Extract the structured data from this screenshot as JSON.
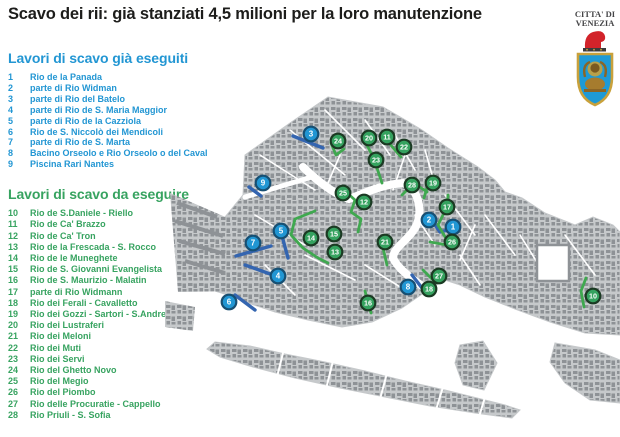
{
  "title": "Scavo dei rii: già stanziati 4,5 milioni per la loro manutenzione",
  "logo": {
    "line1": "CITTA' DI",
    "line2": "VENEZIA"
  },
  "colors": {
    "done": "#2196d3",
    "doneBorder": "#174f72",
    "todo": "#35a25f",
    "todoBorder": "#1b3a23",
    "canalDone": "#3465b0",
    "canalTodo": "#3fa84f",
    "land": "#c6c9cb",
    "building": "#8e9296"
  },
  "lists": {
    "done": {
      "heading": "Lavori di scavo già eseguiti",
      "items": [
        {
          "n": "1",
          "name": "Rio de la Panada"
        },
        {
          "n": "2",
          "name": "parte di Rio Widman"
        },
        {
          "n": "3",
          "name": "parte di Rio del Batelo"
        },
        {
          "n": "4",
          "name": "parte di Rio de S. Maria Maggior"
        },
        {
          "n": "5",
          "name": "parte di Rio de la Cazziola"
        },
        {
          "n": "6",
          "name": "Rio de S. Niccolò dei Mendicoli"
        },
        {
          "n": "7",
          "name": "parte di Rio de S. Marta"
        },
        {
          "n": "8",
          "name": "Bacino Orseolo e Rio Orseolo o del Caval"
        },
        {
          "n": "9",
          "name": "Piscina Rari Nantes"
        }
      ]
    },
    "todo": {
      "heading": "Lavori di scavo da eseguire",
      "items": [
        {
          "n": "10",
          "name": "Rio de S.Daniele - Riello"
        },
        {
          "n": "11",
          "name": "Rio de Ca' Brazzo"
        },
        {
          "n": "12",
          "name": "Rio de Ca' Tron"
        },
        {
          "n": "13",
          "name": "Rio de la Frescada - S. Rocco"
        },
        {
          "n": "14",
          "name": "Rio de le Muneghete"
        },
        {
          "n": "15",
          "name": "Rio de S. Giovanni Evangelista"
        },
        {
          "n": "16",
          "name": "Rio de S. Maurizio - Malatin"
        },
        {
          "n": "17",
          "name": "parte di Rio Widmann"
        },
        {
          "n": "18",
          "name": "Rio dei Ferali - Cavalletto"
        },
        {
          "n": "19",
          "name": "Rio dei Gozzi - Sartori - S.Andrea"
        },
        {
          "n": "20",
          "name": "Rio dei Lustraferi"
        },
        {
          "n": "21",
          "name": "Rio dei Meloni"
        },
        {
          "n": "22",
          "name": "Rio dei Muti"
        },
        {
          "n": "23",
          "name": "Rio dei Servi"
        },
        {
          "n": "24",
          "name": "Rio del Ghetto Novo"
        },
        {
          "n": "25",
          "name": "Rio del Megio"
        },
        {
          "n": "26",
          "name": "Rio del Piombo"
        },
        {
          "n": "27",
          "name": "Rio delle Procuratie - Cappello"
        },
        {
          "n": "28",
          "name": "Rio Priuli - S. Sofia"
        }
      ]
    }
  },
  "map": {
    "markers": [
      {
        "n": "1",
        "type": "done",
        "x": 288,
        "y": 132
      },
      {
        "n": "2",
        "type": "done",
        "x": 264,
        "y": 125
      },
      {
        "n": "3",
        "type": "done",
        "x": 146,
        "y": 39
      },
      {
        "n": "4",
        "type": "done",
        "x": 113,
        "y": 181
      },
      {
        "n": "5",
        "type": "done",
        "x": 116,
        "y": 136
      },
      {
        "n": "6",
        "type": "done",
        "x": 64,
        "y": 207
      },
      {
        "n": "7",
        "type": "done",
        "x": 88,
        "y": 148
      },
      {
        "n": "8",
        "type": "done",
        "x": 243,
        "y": 192
      },
      {
        "n": "9",
        "type": "done",
        "x": 98,
        "y": 88
      },
      {
        "n": "10",
        "type": "todo",
        "x": 428,
        "y": 201
      },
      {
        "n": "11",
        "type": "todo",
        "x": 222,
        "y": 42
      },
      {
        "n": "12",
        "type": "todo",
        "x": 199,
        "y": 107
      },
      {
        "n": "13",
        "type": "todo",
        "x": 170,
        "y": 157
      },
      {
        "n": "14",
        "type": "todo",
        "x": 146,
        "y": 143
      },
      {
        "n": "15",
        "type": "todo",
        "x": 169,
        "y": 139
      },
      {
        "n": "16",
        "type": "todo",
        "x": 203,
        "y": 208
      },
      {
        "n": "17",
        "type": "todo",
        "x": 282,
        "y": 112
      },
      {
        "n": "18",
        "type": "todo",
        "x": 264,
        "y": 194
      },
      {
        "n": "19",
        "type": "todo",
        "x": 268,
        "y": 88
      },
      {
        "n": "20",
        "type": "todo",
        "x": 204,
        "y": 43
      },
      {
        "n": "21",
        "type": "todo",
        "x": 220,
        "y": 147
      },
      {
        "n": "22",
        "type": "todo",
        "x": 239,
        "y": 52
      },
      {
        "n": "23",
        "type": "todo",
        "x": 211,
        "y": 65
      },
      {
        "n": "24",
        "type": "todo",
        "x": 173,
        "y": 46
      },
      {
        "n": "25",
        "type": "todo",
        "x": 178,
        "y": 98
      },
      {
        "n": "26",
        "type": "todo",
        "x": 287,
        "y": 147
      },
      {
        "n": "27",
        "type": "todo",
        "x": 274,
        "y": 181
      },
      {
        "n": "28",
        "type": "todo",
        "x": 247,
        "y": 90
      }
    ],
    "segments": [
      {
        "type": "done",
        "points": [
          [
            128,
            41
          ],
          [
            158,
            53
          ]
        ]
      },
      {
        "type": "done",
        "points": [
          [
            84,
            92
          ],
          [
            96,
            101
          ]
        ]
      },
      {
        "type": "done",
        "points": [
          [
            117,
            141
          ],
          [
            123,
            163
          ]
        ]
      },
      {
        "type": "done",
        "points": [
          [
            71,
            161
          ],
          [
            106,
            151
          ]
        ]
      },
      {
        "type": "done",
        "points": [
          [
            80,
            170
          ],
          [
            108,
            180
          ]
        ]
      },
      {
        "type": "done",
        "points": [
          [
            70,
            200
          ],
          [
            90,
            215
          ]
        ]
      },
      {
        "type": "done",
        "points": [
          [
            247,
            180
          ],
          [
            257,
            193
          ]
        ]
      },
      {
        "type": "done",
        "points": [
          [
            268,
            127
          ],
          [
            275,
            137
          ],
          [
            283,
            135
          ]
        ]
      },
      {
        "type": "todo",
        "points": [
          [
            166,
            48
          ],
          [
            171,
            60
          ],
          [
            179,
            54
          ]
        ]
      },
      {
        "type": "todo",
        "points": [
          [
            200,
            46
          ],
          [
            208,
            62
          ],
          [
            213,
            76
          ],
          [
            217,
            88
          ]
        ]
      },
      {
        "type": "todo",
        "points": [
          [
            224,
            48
          ],
          [
            236,
            62
          ]
        ]
      },
      {
        "type": "todo",
        "points": [
          [
            237,
            100
          ],
          [
            249,
            88
          ],
          [
            262,
            97
          ]
        ]
      },
      {
        "type": "todo",
        "points": [
          [
            264,
            86
          ],
          [
            259,
            103
          ]
        ]
      },
      {
        "type": "todo",
        "points": [
          [
            180,
            96
          ],
          [
            190,
            105
          ],
          [
            186,
            117
          ],
          [
            196,
            124
          ],
          [
            193,
            137
          ]
        ]
      },
      {
        "type": "todo",
        "points": [
          [
            283,
            100
          ],
          [
            282,
            112
          ],
          [
            273,
            130
          ],
          [
            282,
            145
          ]
        ]
      },
      {
        "type": "todo",
        "points": [
          [
            265,
            147
          ],
          [
            282,
            150
          ]
        ]
      },
      {
        "type": "todo",
        "points": [
          [
            150,
            116
          ],
          [
            130,
            124
          ],
          [
            126,
            140
          ],
          [
            138,
            153
          ],
          [
            153,
            163
          ],
          [
            163,
            168
          ]
        ]
      },
      {
        "type": "todo",
        "points": [
          [
            218,
            153
          ],
          [
            222,
            170
          ]
        ]
      },
      {
        "type": "todo",
        "points": [
          [
            200,
            196
          ],
          [
            206,
            218
          ]
        ]
      },
      {
        "type": "todo",
        "points": [
          [
            258,
            175
          ],
          [
            268,
            185
          ],
          [
            280,
            177
          ]
        ]
      },
      {
        "type": "todo",
        "points": [
          [
            421,
            183
          ],
          [
            416,
            196
          ],
          [
            419,
            212
          ]
        ]
      }
    ]
  }
}
